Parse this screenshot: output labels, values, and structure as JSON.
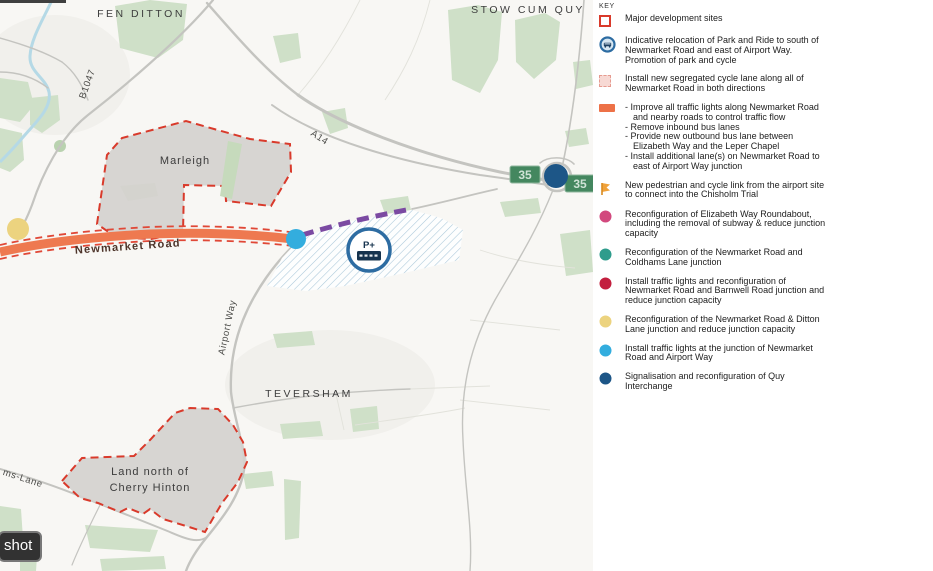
{
  "colors": {
    "dot_pink": "#d2497e",
    "dot_teal": "#2e9c8c",
    "dot_crimson": "#c31f3e",
    "dot_yellow": "#ecd37f",
    "dot_lightblue": "#33adde",
    "dot_darkblue": "#1d5687",
    "road_orange": "#ee7950",
    "cycle_dash_red": "#e04837",
    "bus_lane_purple": "#7b4aa2",
    "site_fill_grey": "#d4d2cf",
    "site_border_red": "#d93a2b",
    "hatch_blue": "#a9c7d9",
    "map_green": "#cfe0c8",
    "road_grey": "#c4c4c0",
    "stream_blue": "#b5d9e6",
    "sign_green": "#44875f",
    "pr_ring_blue": "#2d6ca2"
  },
  "map": {
    "labels": {
      "fen_ditton": "FEN DITTON",
      "stow_cum_quy": "STOW CUM QUY",
      "teversham": "TEVERSHAM",
      "marleigh": "Marleigh",
      "land_north_line1": "Land north of",
      "land_north_line2": "Cherry Hinton",
      "newmarket_road": "Newmarket Road",
      "airport_way": "Airport Way",
      "b1047": "B1047",
      "a14": "A14",
      "lane_fragment": "ms-Lane"
    },
    "route_sign_value": "35",
    "park_ride_symbol": "P+",
    "tooltip_fragment": "shot"
  },
  "legend": {
    "title": "KEY",
    "items": [
      {
        "id": "major-development-sites",
        "label": "Major development sites"
      },
      {
        "id": "park-ride-relocation",
        "label": "Indicative relocation of Park and Ride to south of Newmarket Road and east of Airport Way. Promotion of park and cycle"
      },
      {
        "id": "segregated-cycle-lane",
        "label": "Install new segregated cycle lane along all of Newmarket Road in both directions"
      },
      {
        "id": "newmarket-road-measures",
        "bullets": [
          "- Improve all traffic lights along Newmarket Road and nearby roads to control traffic flow",
          "- Remove inbound bus lanes",
          "- Provide new outbound bus lane between Elizabeth Way and the Leper Chapel",
          "- Install additional lane(s) on Newmarket Road to east of Airport Way junction"
        ]
      },
      {
        "id": "ped-cycle-link",
        "label": "New pedestrian and cycle link from the airport site to connect into the Chisholm Trial"
      },
      {
        "id": "elizabeth-way-roundabout",
        "label": "Reconfiguration of Elizabeth Way Roundabout, including the removal of subway & reduce junction capacity"
      },
      {
        "id": "coldhams-lane-junction",
        "label": "Reconfiguration of the Newmarket Road and Coldhams Lane junction"
      },
      {
        "id": "barnwell-road-junction",
        "label": "Install traffic lights and reconfiguration of Newmarket Road and Barnwell Road junction and reduce junction capacity"
      },
      {
        "id": "ditton-lane-junction",
        "label": "Reconfiguration of the Newmarket Road & Ditton Lane junction and reduce junction capacity"
      },
      {
        "id": "airport-way-junction",
        "label": "Install traffic lights at the junction of Newmarket Road and Airport Way"
      },
      {
        "id": "quy-interchange",
        "label": "Signalisation and reconfiguration of Quy Interchange"
      }
    ]
  },
  "footer": {
    "org": "Greater Cambridge Partnership",
    "project": "Cambridge Eastern Access",
    "option_line1": "Option A2 Hybrid - Newmarket Road",
    "option_line2": "Improvements and Park and Ride",
    "date_label": "DATE: 30.03.21",
    "scale_label": "SCALE: 1:17,500 @ A3"
  }
}
